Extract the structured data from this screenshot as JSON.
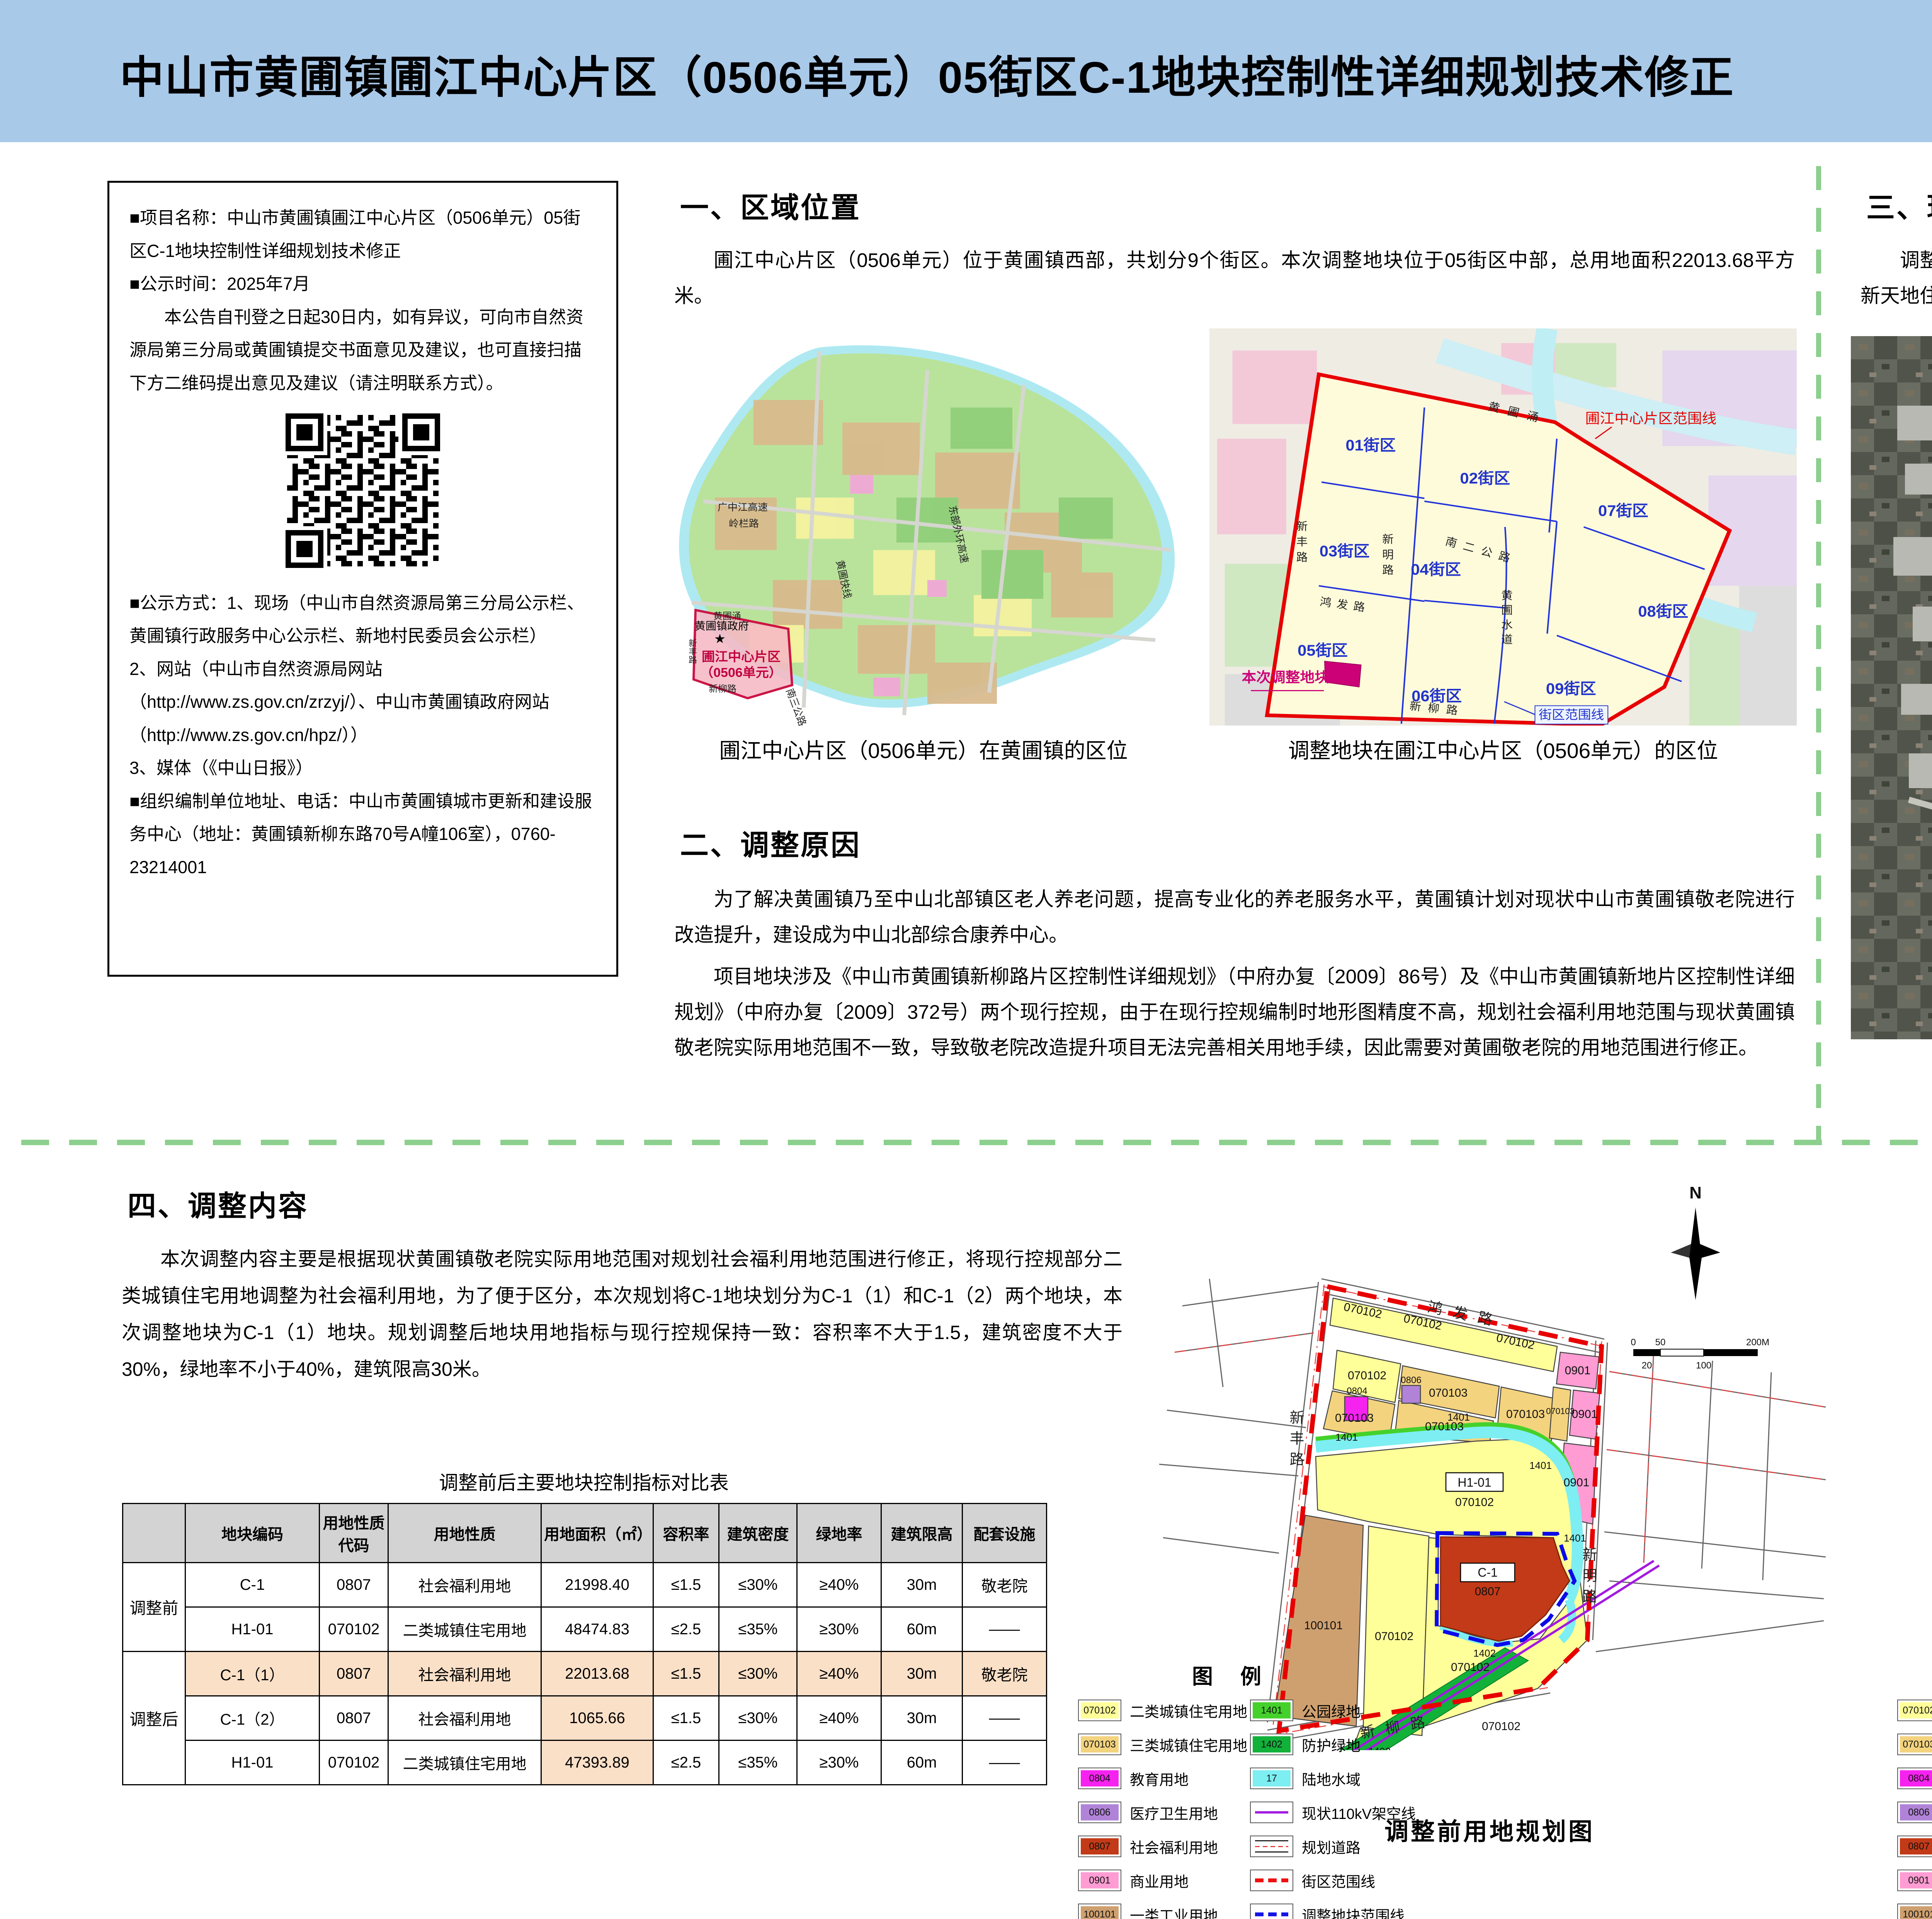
{
  "header": {
    "title": "中山市黄圃镇圃江中心片区（0506单元）05街区C-1地块控制性详细规划技术修正",
    "org_line1": "中山市自然资源局",
    "org_line2": "中山市黄圃镇人民政府",
    "date_line": "2025年7月",
    "stamp": "批前公示"
  },
  "notice": {
    "p1": "■项目名称：中山市黄圃镇圃江中心片区（0506单元）05街区C-1地块控制性详细规划技术修正",
    "p2": "■公示时间：2025年7月",
    "p3": "本公告自刊登之日起30日内，如有异议，可向市自然资源局第三分局或黄圃镇提交书面意见及建议，也可直接扫描下方二维码提出意见及建议（请注明联系方式）。",
    "p4": "■公示方式：1、现场（中山市自然资源局第三分局公示栏、黄圃镇行政服务中心公示栏、新地村民委员会公示栏）",
    "p5": "2、网站（中山市自然资源局网站（http://www.zs.gov.cn/zrzyj/）、中山市黄圃镇政府网站（http://www.zs.gov.cn/hpz/））",
    "p6": "3、媒体（《中山日报》）",
    "p7": "■组织编制单位地址、电话：中山市黄圃镇城市更新和建设服务中心（地址：黄圃镇新柳东路70号A幢106室），0760-23214001"
  },
  "sections": {
    "s1": {
      "heading": "一、区域位置",
      "para": "圃江中心片区（0506单元）位于黄圃镇西部，共划分9个街区。本次调整地块位于05街区中部，总用地面积22013.68平方米。"
    },
    "s2": {
      "heading": "二、调整原因",
      "p1": "为了解决黄圃镇乃至中山北部镇区老人养老问题，提高专业化的养老服务水平，黄圃镇计划对现状中山市黄圃镇敬老院进行改造提升，建设成为中山北部综合康养中心。",
      "p2": "项目地块涉及《中山市黄圃镇新柳路片区控制性详细规划》（中府办复〔2009〕86号）及《中山市黄圃镇新地片区控制性详细规划》（中府办复〔2009〕372号）两个现行控规，由于在现行控规编制时地形图精度不高，规划社会福利用地范围与现状黄圃镇敬老院实际用地范围不一致，导致敬老院改造提升项目无法完善相关用地手续，因此需要对黄圃敬老院的用地范围进行修正。"
    },
    "s3": {
      "heading": "三、现状概况",
      "para": "调整地块现状为黄圃镇敬老院，地块西侧为现状道路，东侧为新地卫生服务站，南侧为荔园新天地住宅小区，北侧为现状村民自建住宅及工业厂房。"
    },
    "s4": {
      "heading": "四、调整内容",
      "para": "本次调整内容主要是根据现状黄圃镇敬老院实际用地范围对规划社会福利用地范围进行修正，将现行控规部分二类城镇住宅用地调整为社会福利用地，为了便于区分，本次规划将C-1地块划分为C-1（1）和C-1（2）两个地块，本次调整地块为C-1（1）地块。规划调整后地块用地指标与现行控规保持一致：容积率不大于1.5，建筑密度不大于30%，绿地率不小于40%，建筑限高30米。"
    }
  },
  "town": {
    "caption": "圃江中心片区（0506单元）在黄圃镇的区位",
    "area1": "圃江中心片区",
    "area2": "（0506单元）",
    "gov": "黄圃镇政府",
    "gov_star": "★",
    "roads": {
      "gzj": "广中江高速",
      "linglan": "岭栏路",
      "kuaixian": "黄圃快线",
      "donghuan": "东部外环高速",
      "nansan": "南三公路",
      "hpyong": "黄圃涌",
      "xinliu": "新柳路",
      "xinfeng": "新丰路"
    }
  },
  "district": {
    "caption": "调整地块在圃江中心片区（0506单元）的区位",
    "blocks": [
      "01街区",
      "02街区",
      "03街区",
      "04街区",
      "05街区",
      "06街区",
      "07街区",
      "08街区",
      "09街区"
    ],
    "boundary": "圃江中心片区范围线",
    "adjust": "本次调整地块",
    "blockline": "街区范围线",
    "roads": {
      "hpyong": "黄圃涌",
      "naner": "南二公路",
      "xinfeng": "新丰路",
      "xinming": "新明路",
      "hongfa": "鸿发路",
      "shuidao": "黄圃水道",
      "xinliu": "新柳路"
    }
  },
  "satellite": {
    "caption": "现状卫星图",
    "adjust": "本次调整地块",
    "home": "黄圃敬老院",
    "clinic": "新地卫生服务站",
    "estate": "荔园新天地",
    "sports": "黄圃体育中心",
    "range": "05街区范围",
    "roads": {
      "xinfeng": "新丰路",
      "xinming": "新明路",
      "xinliu": "新柳路"
    }
  },
  "plan": {
    "caption_before": "调整前用地规划图",
    "caption_after": "调整后用地规划图",
    "c1_before": "C-1",
    "c1_after": "C-1（1）",
    "c2_after": "C-1（2）",
    "h1": "H1-01",
    "codes": {
      "r2": "070102",
      "r3": "070103",
      "edu": "0804",
      "med": "0806",
      "com": "0901",
      "ind": "100101",
      "park": "1401",
      "green": "1402",
      "c0807": "0807"
    },
    "roads": {
      "hongfa": "鸿发路",
      "xinfeng": "新丰路",
      "xinming": "新明路",
      "xinliu": "新柳路"
    },
    "north": "N",
    "scale": {
      "s0": "0",
      "s50": "50",
      "s100": "100",
      "s20": "20",
      "s200": "200M"
    }
  },
  "legend": {
    "title": "图  例",
    "items": [
      {
        "code": "070102",
        "label": "二类城镇住宅用地",
        "color": "#ffff99"
      },
      {
        "code": "070103",
        "label": "三类城镇住宅用地",
        "color": "#f3d37e"
      },
      {
        "code": "0804",
        "label": "教育用地",
        "color": "#f622f0"
      },
      {
        "code": "0806",
        "label": "医疗卫生用地",
        "color": "#b083d8"
      },
      {
        "code": "0807",
        "label": "社会福利用地",
        "color": "#c23a17"
      },
      {
        "code": "0901",
        "label": "商业用地",
        "color": "#ff9cd3"
      },
      {
        "code": "100101",
        "label": "一类工业用地",
        "color": "#cfa06f"
      }
    ],
    "items2": [
      {
        "code": "1401",
        "label": "公园绿地",
        "color": "#45d12b"
      },
      {
        "code": "1402",
        "label": "防护绿地",
        "color": "#12b13a"
      },
      {
        "code": "17",
        "label": "陆地水域",
        "color": "#7deef2"
      }
    ],
    "lines": [
      {
        "label": "现状110kV架空线"
      },
      {
        "label": "规划道路"
      },
      {
        "label": "街区范围线"
      },
      {
        "label": "调整地块范围线"
      }
    ]
  },
  "table": {
    "title": "调整前后主要地块控制指标对比表",
    "headers": [
      "",
      "地块编码",
      "用地性质代码",
      "用地性质",
      "用地面积（㎡）",
      "容积率",
      "建筑密度",
      "绿地率",
      "建筑限高",
      "配套设施"
    ],
    "group_before": "调整前",
    "group_after": "调整后",
    "rows": [
      {
        "code": "C-1",
        "type_code": "0807",
        "use": "社会福利用地",
        "area": "21998.40",
        "far": "≤1.5",
        "density": "≤30%",
        "green": "≥40%",
        "height": "30m",
        "facility": "敬老院"
      },
      {
        "code": "H1-01",
        "type_code": "070102",
        "use": "二类城镇住宅用地",
        "area": "48474.83",
        "far": "≤2.5",
        "density": "≤35%",
        "green": "≥30%",
        "height": "60m",
        "facility": "——"
      },
      {
        "code": "C-1（1）",
        "type_code": "0807",
        "use": "社会福利用地",
        "area": "22013.68",
        "far": "≤1.5",
        "density": "≤30%",
        "green": "≥40%",
        "height": "30m",
        "facility": "敬老院"
      },
      {
        "code": "C-1（2）",
        "type_code": "0807",
        "use": "社会福利用地",
        "area": "1065.66",
        "far": "≤1.5",
        "density": "≤30%",
        "green": "≥40%",
        "height": "30m",
        "facility": "——"
      },
      {
        "code": "H1-01",
        "type_code": "070102",
        "use": "二类城镇住宅用地",
        "area": "47393.89",
        "far": "≤2.5",
        "density": "≤35%",
        "green": "≥30%",
        "height": "60m",
        "facility": "——"
      }
    ]
  }
}
